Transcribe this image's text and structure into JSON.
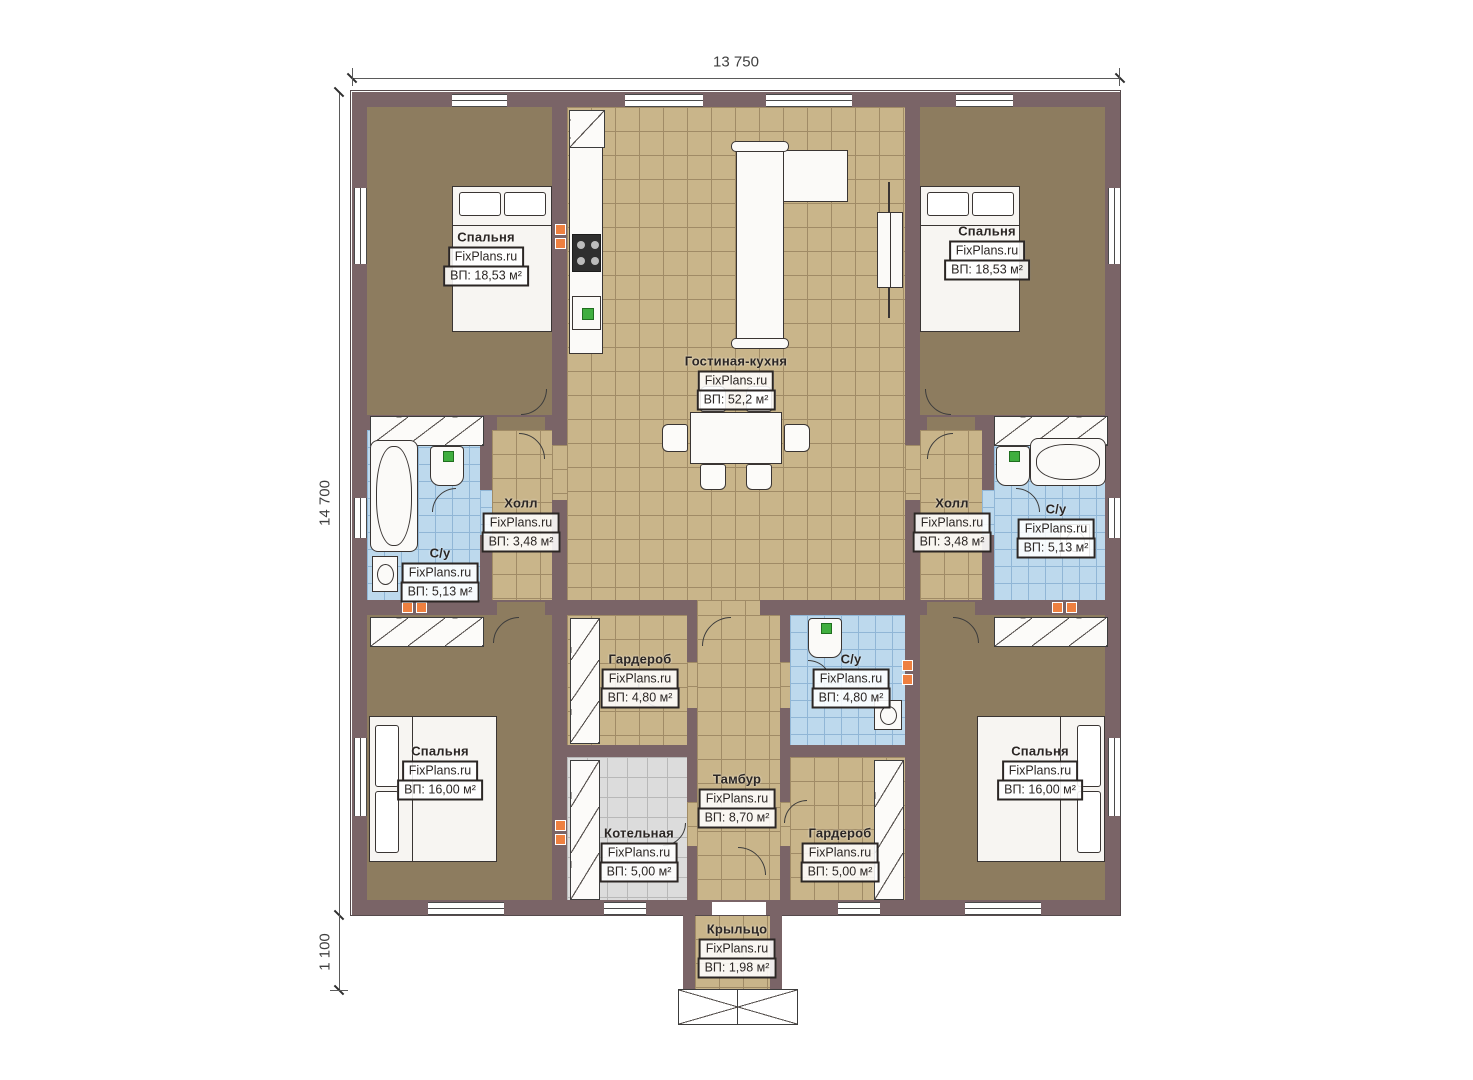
{
  "dimensions": {
    "top": "13 750",
    "left": "14 700",
    "bottom_left": "1 100"
  },
  "colors": {
    "wall": "#7a6467",
    "bedroom_floor": "#8d7c5f",
    "living_tile": "#c9b58a",
    "bathroom_tile": "#bdd9ed",
    "boiler_tile": "#dcdcdc",
    "vent_orange": "#ee8040",
    "fixture_green": "#3fae3f"
  },
  "rooms": [
    {
      "id": "bedroom-top-left",
      "name": "Спальня",
      "brand": "FixPlans.ru",
      "area": "ВП: 18,53 м²"
    },
    {
      "id": "bedroom-top-right",
      "name": "Спальня",
      "brand": "FixPlans.ru",
      "area": "ВП: 18,53 м²"
    },
    {
      "id": "living-kitchen",
      "name": "Гостиная-кухня",
      "brand": "FixPlans.ru",
      "area": "ВП: 52,2 м²"
    },
    {
      "id": "hall-left",
      "name": "Холл",
      "brand": "FixPlans.ru",
      "area": "ВП: 3,48 м²"
    },
    {
      "id": "bathroom-left",
      "name": "С/у",
      "brand": "FixPlans.ru",
      "area": "ВП: 5,13 м²"
    },
    {
      "id": "hall-right",
      "name": "Холл",
      "brand": "FixPlans.ru",
      "area": "ВП: 3,48 м²"
    },
    {
      "id": "bathroom-right",
      "name": "С/у",
      "brand": "FixPlans.ru",
      "area": "ВП: 5,13 м²"
    },
    {
      "id": "wardrobe-left",
      "name": "Гардероб",
      "brand": "FixPlans.ru",
      "area": "ВП: 4,80 м²"
    },
    {
      "id": "bathroom-center",
      "name": "С/у",
      "brand": "FixPlans.ru",
      "area": "ВП: 4,80 м²"
    },
    {
      "id": "vestibule",
      "name": "Тамбур",
      "brand": "FixPlans.ru",
      "area": "ВП: 8,70 м²"
    },
    {
      "id": "boiler-room",
      "name": "Котельная",
      "brand": "FixPlans.ru",
      "area": "ВП: 5,00 м²"
    },
    {
      "id": "wardrobe-right",
      "name": "Гардероб",
      "brand": "FixPlans.ru",
      "area": "ВП: 5,00 м²"
    },
    {
      "id": "bedroom-bottom-left",
      "name": "Спальня",
      "brand": "FixPlans.ru",
      "area": "ВП: 16,00 м²"
    },
    {
      "id": "bedroom-bottom-right",
      "name": "Спальня",
      "brand": "FixPlans.ru",
      "area": "ВП: 16,00 м²"
    },
    {
      "id": "porch",
      "name": "Крыльцо",
      "brand": "FixPlans.ru",
      "area": "ВП: 1,98 м²"
    }
  ]
}
